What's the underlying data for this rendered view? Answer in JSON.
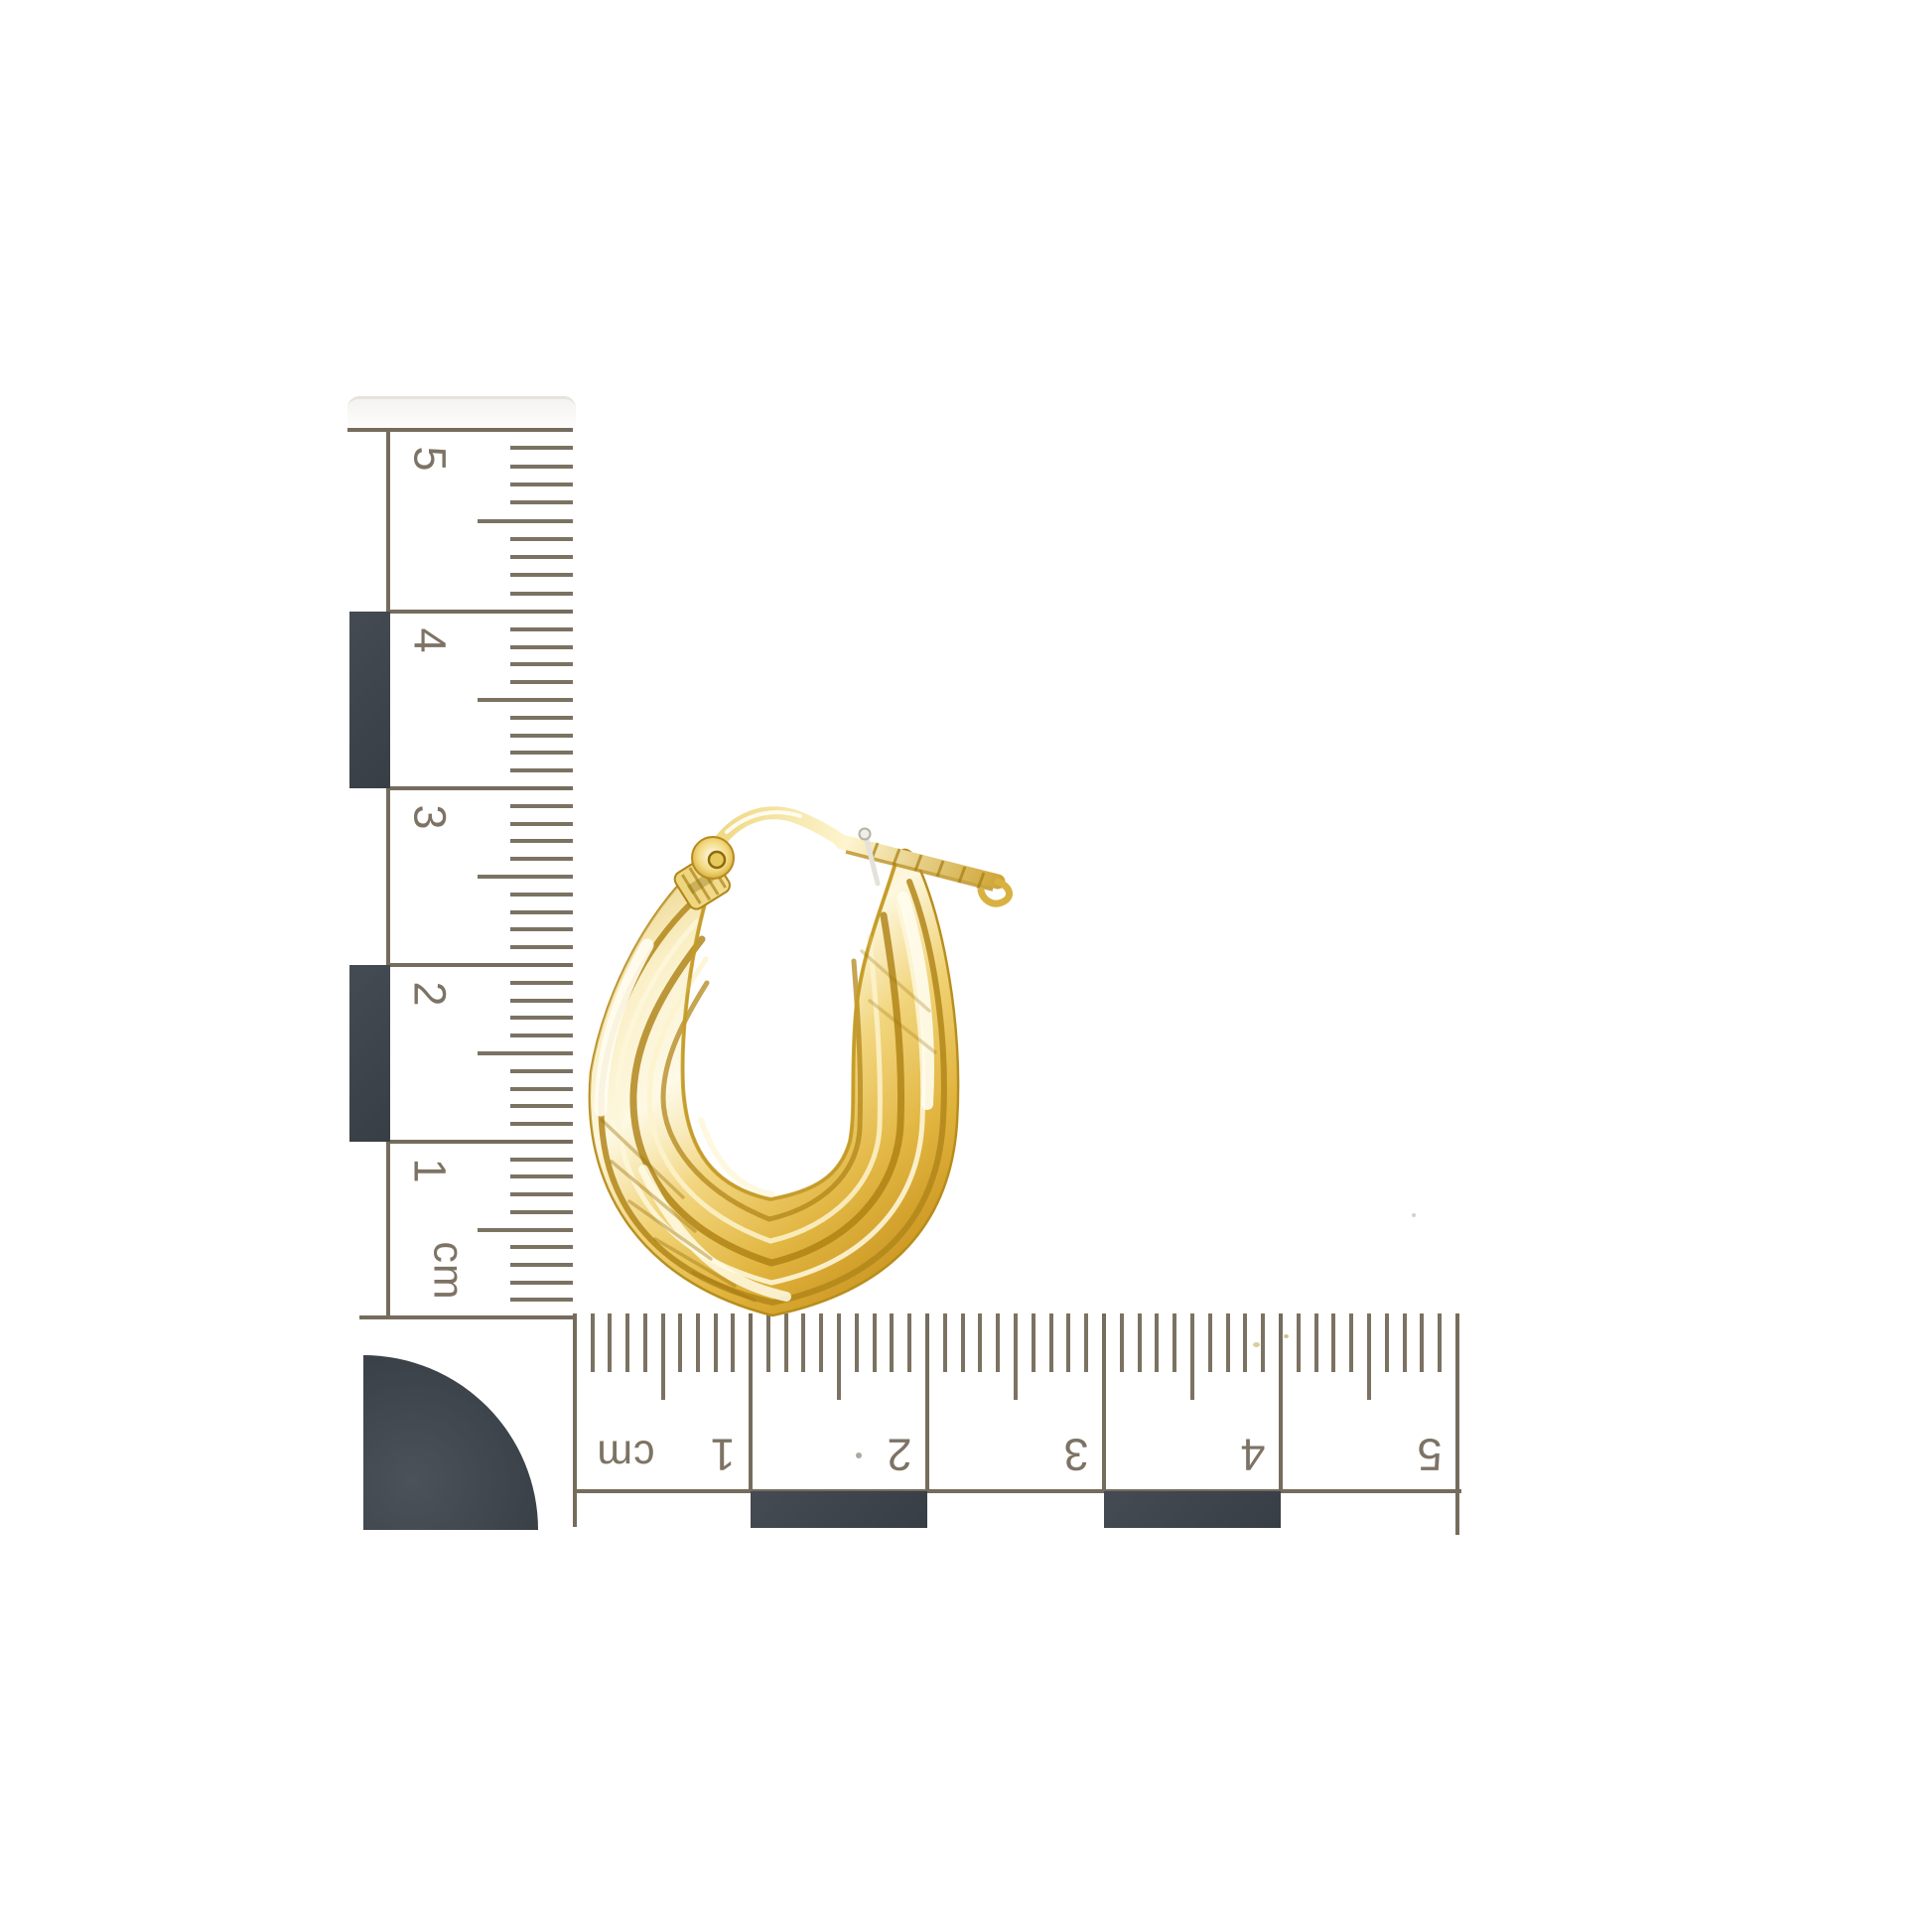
{
  "scene": {
    "description": "Yellow gold ribbed oval creole hoop earring photographed on white with an L-shaped centimetre scale (vertical ruler and inverted horizontal ruler) and black calibration blocks",
    "background": "#ffffff"
  },
  "colors": {
    "ink": "#7d7365",
    "tick": "#7b7262",
    "major_line": "#756c5d",
    "calibration_block": "#3f454c",
    "gold_highlight": "#fdf7dc",
    "gold_mid": "#f0d06d",
    "gold_deep": "#b8871c",
    "silver_pin": "#e4e2da"
  },
  "vertical_ruler": {
    "unit": "cm",
    "numbers": [
      "5",
      "4",
      "3",
      "2",
      "1"
    ],
    "minor_ticks_per_cm": 10,
    "block_pattern": [
      "white",
      "black",
      "white",
      "black",
      "white"
    ],
    "orientation": "numbers rotated 90deg clockwise"
  },
  "horizontal_ruler": {
    "unit": "cm",
    "numbers": [
      "1",
      "2",
      "3",
      "4",
      "5"
    ],
    "minor_ticks_per_cm": 10,
    "block_pattern": [
      "white",
      "black",
      "white",
      "black",
      "white"
    ],
    "orientation": "ruler rotated 180deg (numbers upside down)"
  },
  "corner_marker": {
    "shape": "quarter-circle",
    "radius_cm": 1
  },
  "earring": {
    "name": "gold-oval-hoop-earring",
    "material": "polished yellow gold",
    "pattern": "diagonal ribbed twisted flutes, creole style with lever latch clasp",
    "approx_width_cm": 2.2,
    "approx_height_cm": 2.9
  }
}
